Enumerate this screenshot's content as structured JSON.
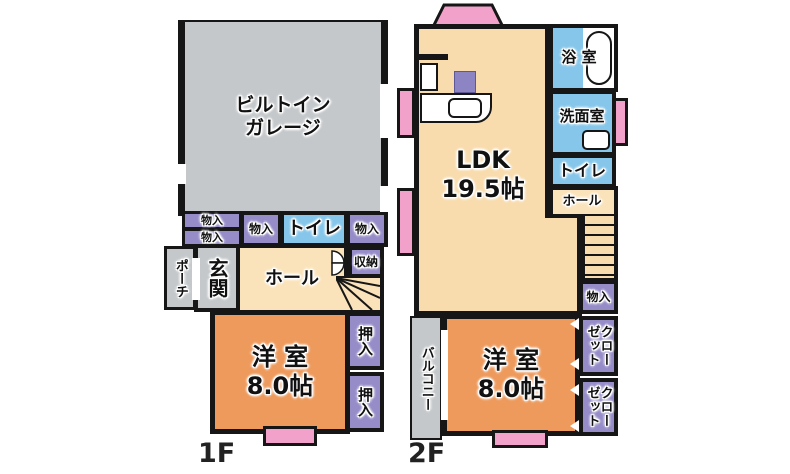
{
  "plan_type": "floor-plan",
  "colors": {
    "wall": "#161616",
    "garage_gray": "#c4c8cb",
    "storage_purple": "#958cc8",
    "water_blue": "#85c6ea",
    "hall_cream": "#fae3ba",
    "ldk_peach": "#f8dcae",
    "room_orange": "#ee9a5c",
    "window_pink": "#f2a2ca"
  },
  "floor1": {
    "label": "1F",
    "garage": "ビルトイン\nガレージ",
    "monoire_a": "物入",
    "monoire_b": "物入",
    "monoire_c": "物入",
    "toilet": "トイレ",
    "monoire_d": "物入",
    "porch": "ポーチ",
    "entrance": "玄関",
    "hall": "ホール",
    "storage": "収納",
    "room": "洋 室\n8.0帖",
    "oshiire_a": "押入",
    "oshiire_b": "押入"
  },
  "floor2": {
    "label": "2F",
    "ldk": "LDK\n19.5帖",
    "bath": "浴 室",
    "washroom": "洗面室",
    "toilet": "トイレ",
    "hall": "ホール",
    "monoire": "物入",
    "room": "洋 室\n8.0帖",
    "balcony": "バルコニー",
    "closet_a": "クローゼット",
    "closet_b": "クローゼット"
  }
}
